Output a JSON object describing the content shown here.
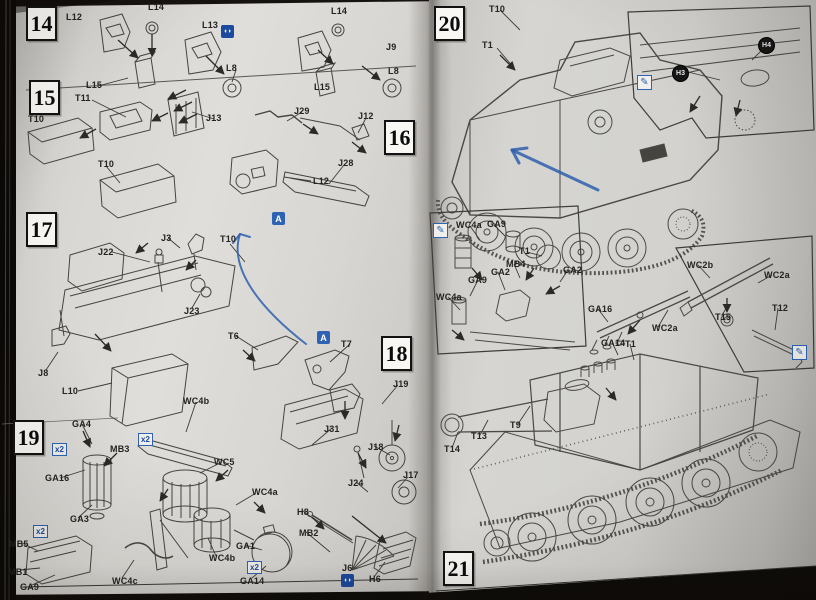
{
  "pen": {
    "color": "#2e5fae"
  },
  "icon_glyphs": {
    "both_sides": "◖◗",
    "cement": "A",
    "x2": "x2",
    "paint": "✎"
  },
  "left_page": {
    "step_boxes": [
      {
        "label": "14",
        "x": 26,
        "y": 6
      },
      {
        "label": "15",
        "x": 29,
        "y": 80
      },
      {
        "label": "16",
        "x": 384,
        "y": 120
      },
      {
        "label": "17",
        "x": 26,
        "y": 212
      },
      {
        "label": "18",
        "x": 381,
        "y": 336
      },
      {
        "label": "19",
        "x": 13,
        "y": 420
      }
    ],
    "part_labels": [
      {
        "t": "L12",
        "x": 66,
        "y": 12
      },
      {
        "t": "L14",
        "x": 148,
        "y": 2
      },
      {
        "t": "L13",
        "x": 202,
        "y": 20
      },
      {
        "t": "L15",
        "x": 86,
        "y": 80
      },
      {
        "t": "L8",
        "x": 226,
        "y": 63
      },
      {
        "t": "L14",
        "x": 331,
        "y": 6
      },
      {
        "t": "J9",
        "x": 386,
        "y": 42
      },
      {
        "t": "L15",
        "x": 314,
        "y": 82
      },
      {
        "t": "L8",
        "x": 388,
        "y": 66
      },
      {
        "t": "T10",
        "x": 28,
        "y": 114
      },
      {
        "t": "T11",
        "x": 75,
        "y": 93
      },
      {
        "t": "J13",
        "x": 206,
        "y": 113
      },
      {
        "t": "J29",
        "x": 294,
        "y": 106
      },
      {
        "t": "J12",
        "x": 358,
        "y": 111
      },
      {
        "t": "J28",
        "x": 338,
        "y": 158
      },
      {
        "t": "L12",
        "x": 313,
        "y": 176
      },
      {
        "t": "T10",
        "x": 98,
        "y": 159
      },
      {
        "t": "J3",
        "x": 161,
        "y": 233
      },
      {
        "t": "T10",
        "x": 220,
        "y": 234
      },
      {
        "t": "J22",
        "x": 98,
        "y": 247
      },
      {
        "t": "J23",
        "x": 184,
        "y": 306
      },
      {
        "t": "J8",
        "x": 38,
        "y": 368
      },
      {
        "t": "L10",
        "x": 62,
        "y": 386
      },
      {
        "t": "T6",
        "x": 228,
        "y": 331
      },
      {
        "t": "T7",
        "x": 341,
        "y": 339
      },
      {
        "t": "J19",
        "x": 393,
        "y": 379
      },
      {
        "t": "J31",
        "x": 324,
        "y": 424
      },
      {
        "t": "J18",
        "x": 368,
        "y": 442
      },
      {
        "t": "J24",
        "x": 348,
        "y": 478
      },
      {
        "t": "J17",
        "x": 403,
        "y": 470
      },
      {
        "t": "GA4",
        "x": 72,
        "y": 419
      },
      {
        "t": "MB3",
        "x": 110,
        "y": 444
      },
      {
        "t": "GA16",
        "x": 45,
        "y": 473
      },
      {
        "t": "GA3",
        "x": 70,
        "y": 514
      },
      {
        "t": "MB5",
        "x": 9,
        "y": 539
      },
      {
        "t": "MB1",
        "x": 8,
        "y": 567
      },
      {
        "t": "GA9",
        "x": 20,
        "y": 582
      },
      {
        "t": "WC4b",
        "x": 183,
        "y": 396
      },
      {
        "t": "WC5",
        "x": 214,
        "y": 457
      },
      {
        "t": "WC4b",
        "x": 209,
        "y": 553
      },
      {
        "t": "WC4c",
        "x": 112,
        "y": 576
      },
      {
        "t": "WC4a",
        "x": 252,
        "y": 487
      },
      {
        "t": "GA1",
        "x": 236,
        "y": 541
      },
      {
        "t": "GA14",
        "x": 240,
        "y": 576
      },
      {
        "t": "H8",
        "x": 297,
        "y": 507
      },
      {
        "t": "MB2",
        "x": 299,
        "y": 528
      },
      {
        "t": "J6",
        "x": 342,
        "y": 563
      },
      {
        "t": "H6",
        "x": 369,
        "y": 574
      }
    ],
    "icons": [
      {
        "type": "both_sides",
        "x": 221,
        "y": 25
      },
      {
        "type": "cement",
        "x": 272,
        "y": 212
      },
      {
        "type": "cement",
        "x": 317,
        "y": 331
      },
      {
        "type": "x2",
        "x": 52,
        "y": 443
      },
      {
        "type": "x2",
        "x": 138,
        "y": 433
      },
      {
        "type": "x2",
        "x": 33,
        "y": 525
      },
      {
        "type": "x2",
        "x": 247,
        "y": 561
      },
      {
        "type": "both_sides",
        "x": 341,
        "y": 574
      }
    ]
  },
  "right_page": {
    "step_boxes": [
      {
        "label": "20",
        "x": 434,
        "y": 6
      },
      {
        "label": "21",
        "x": 443,
        "y": 551
      }
    ],
    "part_labels": [
      {
        "t": "T10",
        "x": 489,
        "y": 4
      },
      {
        "t": "T1",
        "x": 482,
        "y": 40
      },
      {
        "t": "WC4a",
        "x": 456,
        "y": 220
      },
      {
        "t": "GA9",
        "x": 487,
        "y": 219
      },
      {
        "t": "T1",
        "x": 519,
        "y": 246
      },
      {
        "t": "MB4",
        "x": 506,
        "y": 259
      },
      {
        "t": "GA2",
        "x": 491,
        "y": 267
      },
      {
        "t": "GA9",
        "x": 468,
        "y": 275
      },
      {
        "t": "GA2",
        "x": 563,
        "y": 265
      },
      {
        "t": "WC4a",
        "x": 436,
        "y": 292
      },
      {
        "t": "GA16",
        "x": 588,
        "y": 304
      },
      {
        "t": "WC2a",
        "x": 652,
        "y": 323
      },
      {
        "t": "GA14",
        "x": 601,
        "y": 338
      },
      {
        "t": "T1",
        "x": 625,
        "y": 339
      },
      {
        "t": "WC2b",
        "x": 687,
        "y": 260
      },
      {
        "t": "WC2a",
        "x": 764,
        "y": 270
      },
      {
        "t": "T15",
        "x": 715,
        "y": 312
      },
      {
        "t": "T12",
        "x": 772,
        "y": 303
      },
      {
        "t": "T14",
        "x": 444,
        "y": 444
      },
      {
        "t": "T13",
        "x": 471,
        "y": 431
      },
      {
        "t": "T9",
        "x": 510,
        "y": 420
      }
    ],
    "circled_labels": [
      {
        "t": "H4",
        "x": 758,
        "y": 37
      },
      {
        "t": "H3",
        "x": 672,
        "y": 65
      }
    ],
    "icons": [
      {
        "type": "paint",
        "x": 637,
        "y": 75
      },
      {
        "type": "paint",
        "x": 433,
        "y": 223
      },
      {
        "type": "paint",
        "x": 792,
        "y": 345
      }
    ]
  },
  "pen_annotations": [
    {
      "d": "M240,234 C230,264 252,302 306,344",
      "w": 2
    },
    {
      "d": "M240,234 l-7,9 M240,234 l10,3",
      "w": 2
    },
    {
      "d": "M512,150 L598,190",
      "w": 3
    },
    {
      "d": "M512,150 l15,-2 M512,150 l7,13",
      "w": 3
    }
  ]
}
